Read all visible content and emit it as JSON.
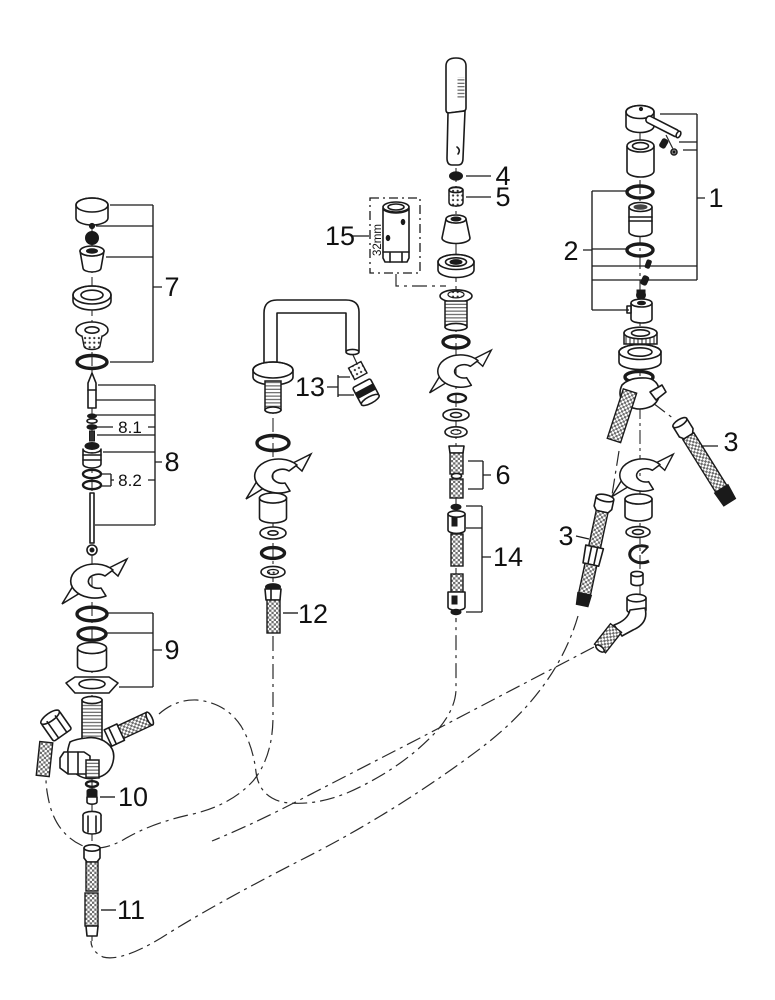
{
  "diagram": {
    "background": "#ffffff",
    "ink": "#1a1a1a",
    "callouts": {
      "n1": "1",
      "n2": "2",
      "n3": "3",
      "n4": "4",
      "n5": "5",
      "n6": "6",
      "n7": "7",
      "n8": "8",
      "n8_1": "8.1",
      "n8_2": "8.2",
      "n9": "9",
      "n10": "10",
      "n11": "11",
      "n12": "12",
      "n13": "13",
      "n14": "14",
      "n15": "15"
    },
    "annotations": {
      "tool_size": "32mm"
    }
  }
}
